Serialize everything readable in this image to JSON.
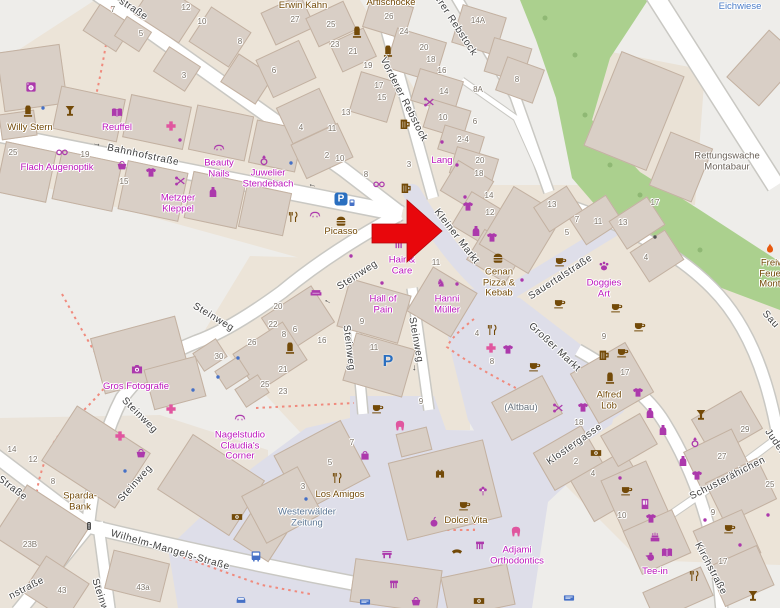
{
  "map": {
    "place": "Montabaur town centre",
    "marker": {
      "type": "red-arrow",
      "points_at": "Kleiner Markt",
      "x": 372,
      "y": 200,
      "tip_x": 442,
      "tip_y": 231,
      "color": "#e8070c"
    },
    "colors": {
      "land": "#eeedea",
      "landuse": "#ece4d8",
      "building": "#d9cfc6",
      "building_outline": "#c3b1a1",
      "road": "#ffffff",
      "road_casing": "#c9c8c3",
      "pedestrian": "#dedee9",
      "green": "#abd08e",
      "boundary_dots": "#f08a7d",
      "br": "#734a08",
      "m": "#ac39ac",
      "pk": "#e0569f",
      "bl": "#4570c6",
      "or": "#e8590f",
      "dk": "#555555",
      "gray": "#6a6158",
      "bluegray": "#5d7795",
      "blue": "#4b7dc8",
      "g2": "#66707a",
      "label_magenta": "#bc16bc",
      "street_label": "#3e3e3e",
      "house_number": "#7d7469"
    },
    "street_labels": [
      {
        "t": "Bahnhofstraße",
        "x": 143,
        "y": 156,
        "r": 12
      },
      {
        "t": "straße",
        "x": 133,
        "y": 10,
        "r": 33
      },
      {
        "t": "Vorderer Rebstock",
        "x": 403,
        "y": 100,
        "r": 63
      },
      {
        "t": "erer Rebstock",
        "x": 455,
        "y": 26,
        "r": 57
      },
      {
        "t": "Kleiner Markt",
        "x": 456,
        "y": 237,
        "r": 52
      },
      {
        "t": "Sauertalstraße",
        "x": 561,
        "y": 278,
        "r": -33
      },
      {
        "t": "Großer Markt",
        "x": 554,
        "y": 348,
        "r": 43
      },
      {
        "t": "Steinweg",
        "x": 213,
        "y": 318,
        "r": 31
      },
      {
        "t": "Steinweg",
        "x": 358,
        "y": 276,
        "r": -33
      },
      {
        "t": "Steinweg",
        "x": 348,
        "y": 348,
        "r": 83
      },
      {
        "t": "Steinweg",
        "x": 415,
        "y": 340,
        "r": 80
      },
      {
        "t": "Steinweg",
        "x": 139,
        "y": 416,
        "r": 45
      },
      {
        "t": "Steinweg",
        "x": 136,
        "y": 484,
        "r": -48
      },
      {
        "t": "Steinweg",
        "x": 101,
        "y": 601,
        "r": 72
      },
      {
        "t": "Wilhelm-Mangels-Straße",
        "x": 170,
        "y": 551,
        "r": 16
      },
      {
        "t": "Klostergasse",
        "x": 575,
        "y": 445,
        "r": -35
      },
      {
        "t": "Schusterähichen",
        "x": 728,
        "y": 479,
        "r": -27
      },
      {
        "t": "Kirchstraße",
        "x": 710,
        "y": 569,
        "r": 62
      },
      {
        "t": "Juden",
        "x": 775,
        "y": 443,
        "r": 55
      },
      {
        "t": "Sau",
        "x": 770,
        "y": 320,
        "r": 48
      },
      {
        "t": "Straße",
        "x": 12,
        "y": 489,
        "r": 37
      },
      {
        "t": "nstraße",
        "x": 27,
        "y": 589,
        "r": -27
      }
    ],
    "poi_labels": [
      {
        "t": "Willy Stern",
        "x": 30,
        "y": 128,
        "c": "br"
      },
      {
        "t": "Reuffel",
        "x": 117,
        "y": 128,
        "c": "label_magenta"
      },
      {
        "t": "Erwin Kahn",
        "x": 303,
        "y": 6,
        "c": "br"
      },
      {
        "t": "Artischocke",
        "x": 391,
        "y": 3,
        "c": "br"
      },
      {
        "t": "Picasso",
        "x": 341,
        "y": 232,
        "c": "br"
      },
      {
        "t": "Cenan\nPizza &\nKebab",
        "x": 499,
        "y": 283,
        "c": "br"
      },
      {
        "t": "Alfred\nLöb",
        "x": 609,
        "y": 401,
        "c": "br"
      },
      {
        "t": "Los Amigos",
        "x": 340,
        "y": 495,
        "c": "br"
      },
      {
        "t": "Dolce Vita",
        "x": 466,
        "y": 521,
        "c": "br"
      },
      {
        "t": "Sparda-\nBank",
        "x": 80,
        "y": 502,
        "c": "br"
      },
      {
        "t": "Lang",
        "x": 442,
        "y": 161,
        "c": "label_magenta"
      },
      {
        "t": "Rettungswache\nMontabaur",
        "x": 727,
        "y": 162,
        "c": "gray"
      },
      {
        "t": "Freiwillige\nFeuerwehr\nMontabaur",
        "x": 782,
        "y": 274,
        "c": "br"
      },
      {
        "t": "Flach Augenoptik",
        "x": 57,
        "y": 168,
        "c": "label_magenta"
      },
      {
        "t": "Beauty\nNails",
        "x": 219,
        "y": 169,
        "c": "label_magenta"
      },
      {
        "t": "Juwelier\nStendebach",
        "x": 268,
        "y": 179,
        "c": "label_magenta"
      },
      {
        "t": "Metzger\nKleppel",
        "x": 178,
        "y": 204,
        "c": "label_magenta"
      },
      {
        "t": "Hair &\nCare",
        "x": 402,
        "y": 266,
        "c": "label_magenta"
      },
      {
        "t": "Hall of\nPain",
        "x": 383,
        "y": 305,
        "c": "label_magenta"
      },
      {
        "t": "Hanni\nMüller",
        "x": 447,
        "y": 305,
        "c": "label_magenta"
      },
      {
        "t": "Doggies\nArt",
        "x": 604,
        "y": 289,
        "c": "label_magenta"
      },
      {
        "t": "Gros Fotografie",
        "x": 136,
        "y": 387,
        "c": "label_magenta"
      },
      {
        "t": "Nagelstudio\nClaudia's\nCorner",
        "x": 240,
        "y": 446,
        "c": "label_magenta"
      },
      {
        "t": "Tee-in",
        "x": 655,
        "y": 572,
        "c": "label_magenta"
      },
      {
        "t": "Adjami\nOrthodontics",
        "x": 517,
        "y": 556,
        "c": "label_magenta"
      },
      {
        "t": "Westerwälder\nZeitung",
        "x": 307,
        "y": 518,
        "c": "bluegray"
      },
      {
        "t": "(Altbau)",
        "x": 521,
        "y": 408,
        "c": "g2"
      },
      {
        "t": "Eichwiese",
        "x": 740,
        "y": 7,
        "c": "blue"
      }
    ],
    "house_numbers": [
      [
        "7",
        113,
        10
      ],
      [
        "12",
        186,
        8
      ],
      [
        "10",
        202,
        22
      ],
      [
        "5",
        141,
        34
      ],
      [
        "8",
        240,
        42
      ],
      [
        "3",
        184,
        76
      ],
      [
        "25",
        13,
        153
      ],
      [
        "19",
        85,
        155
      ],
      [
        "15",
        124,
        182
      ],
      [
        "27",
        295,
        20
      ],
      [
        "25",
        331,
        25
      ],
      [
        "23",
        335,
        45
      ],
      [
        "21",
        353,
        52
      ],
      [
        "19",
        368,
        66
      ],
      [
        "26",
        389,
        17
      ],
      [
        "24",
        404,
        32
      ],
      [
        "20",
        424,
        48
      ],
      [
        "18",
        431,
        60
      ],
      [
        "16",
        442,
        71
      ],
      [
        "17",
        379,
        86
      ],
      [
        "15",
        382,
        98
      ],
      [
        "13",
        346,
        113
      ],
      [
        "14",
        444,
        92
      ],
      [
        "8A",
        478,
        90
      ],
      [
        "14A",
        478,
        21
      ],
      [
        "8",
        517,
        80
      ],
      [
        "6",
        274,
        71
      ],
      [
        "4",
        301,
        128
      ],
      [
        "11",
        332,
        129
      ],
      [
        "2",
        327,
        156
      ],
      [
        "10",
        340,
        159
      ],
      [
        "3",
        409,
        165
      ],
      [
        "8",
        366,
        175
      ],
      [
        "10",
        443,
        118
      ],
      [
        "6",
        475,
        122
      ],
      [
        "2-4",
        463,
        140
      ],
      [
        "20",
        480,
        161
      ],
      [
        "18",
        479,
        174
      ],
      [
        "14",
        489,
        196
      ],
      [
        "12",
        490,
        213
      ],
      [
        "13",
        552,
        205
      ],
      [
        "7",
        577,
        220
      ],
      [
        "11",
        598,
        222
      ],
      [
        "13",
        623,
        223
      ],
      [
        "5",
        567,
        233
      ],
      [
        "17",
        655,
        203
      ],
      [
        "4",
        646,
        258
      ],
      [
        "11",
        436,
        263
      ],
      [
        "9",
        362,
        322
      ],
      [
        "11",
        374,
        348
      ],
      [
        "16",
        322,
        341
      ],
      [
        "20",
        278,
        307
      ],
      [
        "22",
        273,
        325
      ],
      [
        "21",
        283,
        370
      ],
      [
        "25",
        265,
        385
      ],
      [
        "23",
        283,
        392
      ],
      [
        "8",
        284,
        335
      ],
      [
        "6",
        295,
        330
      ],
      [
        "9",
        604,
        337
      ],
      [
        "4",
        477,
        334
      ],
      [
        "8",
        492,
        362
      ],
      [
        "7",
        352,
        443
      ],
      [
        "5",
        330,
        463
      ],
      [
        "3",
        303,
        487
      ],
      [
        "9",
        421,
        402
      ],
      [
        "14",
        12,
        450
      ],
      [
        "12",
        33,
        460
      ],
      [
        "8",
        53,
        482
      ],
      [
        "23B",
        30,
        545
      ],
      [
        "43",
        62,
        591
      ],
      [
        "43a",
        143,
        588
      ],
      [
        "30",
        219,
        357
      ],
      [
        "26",
        252,
        343
      ],
      [
        "18",
        579,
        423
      ],
      [
        "2",
        576,
        462
      ],
      [
        "4",
        593,
        474
      ],
      [
        "17",
        625,
        373
      ],
      [
        "10",
        622,
        516
      ],
      [
        "29",
        745,
        430
      ],
      [
        "27",
        722,
        457
      ],
      [
        "25",
        770,
        485
      ],
      [
        "9",
        713,
        513
      ],
      [
        "17",
        723,
        562
      ]
    ],
    "pois": [
      [
        "memorial",
        28,
        112,
        "br"
      ],
      [
        "dot",
        43,
        108,
        "bl"
      ],
      [
        "goblet",
        70,
        111,
        "br"
      ],
      [
        "laundry",
        31,
        87,
        "m"
      ],
      [
        "book",
        117,
        113,
        "m"
      ],
      [
        "cross",
        171,
        126,
        "pk"
      ],
      [
        "dot",
        180,
        140,
        "m"
      ],
      [
        "glasses",
        62,
        152,
        "m"
      ],
      [
        "basket",
        122,
        165,
        "m"
      ],
      [
        "tshirt",
        151,
        173,
        "m"
      ],
      [
        "scissors",
        180,
        181,
        "m"
      ],
      [
        "bottle",
        213,
        192,
        "m"
      ],
      [
        "eyelash",
        219,
        147,
        "m"
      ],
      [
        "ring",
        264,
        160,
        "m"
      ],
      [
        "dot",
        291,
        163,
        "bl"
      ],
      [
        "memorial",
        357,
        33,
        "br"
      ],
      [
        "memorial",
        388,
        52,
        "br"
      ],
      [
        "mug",
        405,
        124,
        "br"
      ],
      [
        "scissors",
        429,
        102,
        "m"
      ],
      [
        "glasses",
        379,
        184,
        "m"
      ],
      [
        "mug",
        406,
        188,
        "br"
      ],
      [
        "forkknife",
        293,
        217,
        "br"
      ],
      [
        "eyelash",
        315,
        214,
        "m"
      ],
      [
        "hamburger",
        341,
        221,
        "br"
      ],
      [
        "dot",
        351,
        256,
        "m"
      ],
      [
        "comb",
        399,
        245,
        "m"
      ],
      [
        "dot",
        382,
        283,
        "m"
      ],
      [
        "sofa",
        316,
        293,
        "m"
      ],
      [
        "memorial",
        290,
        349,
        "br"
      ],
      [
        "horse",
        441,
        283,
        "m"
      ],
      [
        "dot",
        457,
        284,
        "m"
      ],
      [
        "tshirt",
        468,
        207,
        "m"
      ],
      [
        "bottle",
        476,
        231,
        "m"
      ],
      [
        "tshirt",
        492,
        238,
        "m"
      ],
      [
        "dot",
        465,
        197,
        "m"
      ],
      [
        "hamburger",
        498,
        258,
        "br"
      ],
      [
        "dot",
        522,
        280,
        "m"
      ],
      [
        "paw",
        604,
        266,
        "m"
      ],
      [
        "cup",
        561,
        261,
        "br"
      ],
      [
        "cup",
        560,
        303,
        "br"
      ],
      [
        "cup",
        617,
        307,
        "br"
      ],
      [
        "cup",
        640,
        326,
        "br"
      ],
      [
        "cup",
        623,
        352,
        "br"
      ],
      [
        "mug",
        604,
        355,
        "br"
      ],
      [
        "cup",
        535,
        366,
        "br"
      ],
      [
        "forkknife",
        492,
        330,
        "br"
      ],
      [
        "cross",
        491,
        348,
        "pk"
      ],
      [
        "tshirt",
        508,
        350,
        "m"
      ],
      [
        "memorial",
        610,
        379,
        "br"
      ],
      [
        "tshirt",
        638,
        393,
        "m"
      ],
      [
        "scissors",
        558,
        408,
        "m"
      ],
      [
        "tshirt",
        583,
        408,
        "m"
      ],
      [
        "bottle",
        650,
        413,
        "m"
      ],
      [
        "banknote",
        596,
        453,
        "br"
      ],
      [
        "goblet",
        701,
        415,
        "br"
      ],
      [
        "bottle",
        663,
        430,
        "m"
      ],
      [
        "ring",
        695,
        442,
        "m"
      ],
      [
        "bottle",
        683,
        461,
        "m"
      ],
      [
        "tshirt",
        697,
        476,
        "m"
      ],
      [
        "dot",
        705,
        520,
        "m"
      ],
      [
        "cup",
        730,
        528,
        "br"
      ],
      [
        "dot",
        768,
        515,
        "m"
      ],
      [
        "dot",
        740,
        545,
        "m"
      ],
      [
        "camera",
        137,
        369,
        "m"
      ],
      [
        "eyelash",
        240,
        417,
        "m"
      ],
      [
        "banknote",
        237,
        517,
        "br"
      ],
      [
        "bus",
        256,
        556,
        "bl"
      ],
      [
        "car",
        241,
        600,
        "bl"
      ],
      [
        "cross",
        171,
        409,
        "pk"
      ],
      [
        "cross",
        120,
        436,
        "pk"
      ],
      [
        "basket",
        141,
        453,
        "m"
      ],
      [
        "dot",
        125,
        471,
        "bl"
      ],
      [
        "bag",
        365,
        455,
        "m"
      ],
      [
        "forkknife",
        337,
        478,
        "br"
      ],
      [
        "dot",
        306,
        499,
        "bl"
      ],
      [
        "bench",
        387,
        554,
        "m"
      ],
      [
        "cup",
        378,
        408,
        "br"
      ],
      [
        "tooth",
        400,
        426,
        "pk"
      ],
      [
        "castle",
        440,
        473,
        "br"
      ],
      [
        "flower",
        483,
        491,
        "m"
      ],
      [
        "cup",
        465,
        505,
        "br"
      ],
      [
        "apple",
        434,
        522,
        "m"
      ],
      [
        "tooth",
        516,
        532,
        "pk"
      ],
      [
        "phone",
        457,
        553,
        "br"
      ],
      [
        "comb",
        480,
        546,
        "m"
      ],
      [
        "comb",
        394,
        585,
        "m"
      ],
      [
        "basket",
        416,
        601,
        "m"
      ],
      [
        "banknote",
        479,
        601,
        "br"
      ],
      [
        "teapot",
        650,
        556,
        "m"
      ],
      [
        "book",
        667,
        553,
        "m"
      ],
      [
        "cake",
        655,
        537,
        "m"
      ],
      [
        "forkknife",
        694,
        576,
        "br"
      ],
      [
        "goblet",
        753,
        596,
        "br"
      ],
      [
        "bluesign",
        569,
        598,
        "bl"
      ],
      [
        "bluesign",
        365,
        602,
        "bl"
      ],
      [
        "fire",
        770,
        249,
        "or"
      ],
      [
        "dot",
        442,
        142,
        "m"
      ],
      [
        "dot",
        457,
        165,
        "m"
      ],
      [
        "dot",
        193,
        390,
        "bl"
      ],
      [
        "dot",
        218,
        377,
        "bl"
      ],
      [
        "dot",
        238,
        358,
        "bl"
      ],
      [
        "dot",
        655,
        237,
        "dk"
      ],
      [
        "vending",
        645,
        504,
        "m"
      ],
      [
        "tshirt",
        651,
        519,
        "m"
      ],
      [
        "cup",
        627,
        490,
        "br"
      ],
      [
        "dot",
        620,
        478,
        "m"
      ],
      [
        "traffic",
        89,
        527,
        "dk"
      ]
    ],
    "oneway_arrows": [
      {
        "x": 97,
        "y": 143,
        "r": 12
      },
      {
        "x": 312,
        "y": 187,
        "r": 195
      },
      {
        "x": 327,
        "y": 303,
        "r": 210
      },
      {
        "x": 416,
        "y": 368,
        "r": 95
      }
    ],
    "parking": [
      {
        "style": "box",
        "x": 341,
        "y": 199,
        "label": "P"
      },
      {
        "style": "machine",
        "x": 352,
        "y": 203
      },
      {
        "style": "letter",
        "x": 388,
        "y": 362,
        "label": "P"
      }
    ]
  }
}
